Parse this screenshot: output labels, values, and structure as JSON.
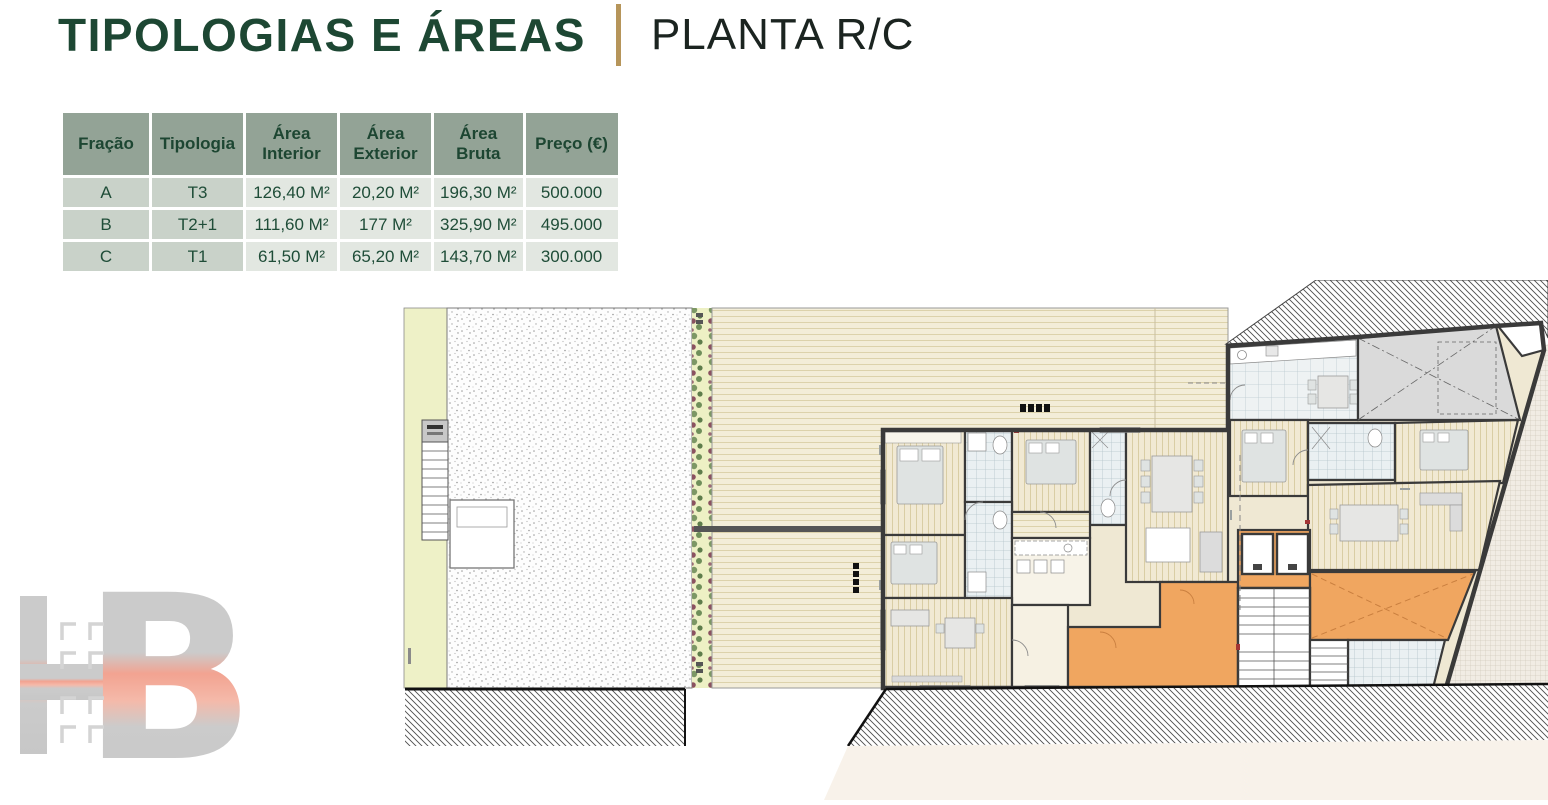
{
  "header": {
    "title": "TIPOLOGIAS E ÁREAS",
    "plan_title": "PLANTA R/C"
  },
  "table": {
    "headers": [
      "Fração",
      "Tipologia",
      "Área Interior",
      "Área Exterior",
      "Área Bruta",
      "Preço (€)"
    ],
    "rows": [
      {
        "cells": [
          "A",
          "T3",
          "126,40 M²",
          "20,20 M²",
          "196,30 M²",
          "500.000"
        ]
      },
      {
        "cells": [
          "B",
          "T2+1",
          "111,60 M²",
          "177 M²",
          "325,90 M²",
          "495.000"
        ]
      },
      {
        "cells": [
          "C",
          "T1",
          "61,50 M²",
          "65,20 M²",
          "143,70 M²",
          "300.000"
        ]
      }
    ]
  },
  "logo": {
    "monogram": "HB"
  },
  "plan": {
    "colors": {
      "accent_gold": "#b6955a",
      "title_green": "#1d4733",
      "table_header_bg": "#93a396",
      "table_label_bg": "#c9d2c9",
      "table_value_bg": "#e2e7e1",
      "wall": "#3a3a3a",
      "deck": "#f3edd8",
      "plank": "#f1e9d3",
      "tile": "#eaf0f2",
      "circulation_orange": "#f0a660",
      "garage_gray": "#dadada",
      "garden_yellow": "#eef1c7",
      "vegetation_green": "#7c9765",
      "logo_gray": "#cbcbcb",
      "logo_pink": "#f2a391"
    }
  }
}
